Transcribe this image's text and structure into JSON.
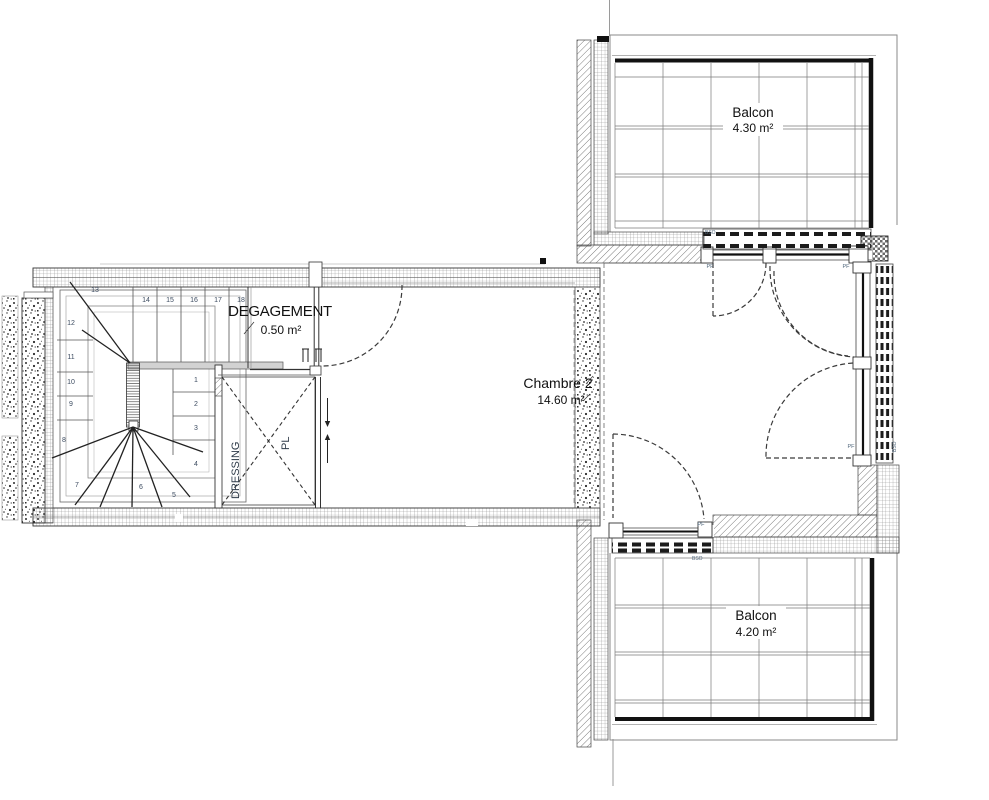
{
  "plan": {
    "rooms": {
      "degagement": {
        "name": "DEGAGEMENT",
        "area": "0.50 m²"
      },
      "chambre2": {
        "name": "Chambre 2",
        "area": "14.60 m²"
      },
      "balcon_top": {
        "name": "Balcon",
        "area": "4.30 m²"
      },
      "balcon_bottom": {
        "name": "Balcon",
        "area": "4.20 m²"
      },
      "dressing": {
        "name": "DRESSING"
      },
      "placard": {
        "name": "PL"
      }
    },
    "stair_steps": [
      "1",
      "2",
      "3",
      "4",
      "5",
      "6",
      "7",
      "8",
      "9",
      "10",
      "11",
      "12",
      "13",
      "14",
      "15",
      "16",
      "17",
      "18"
    ],
    "window_labels": {
      "pf": "PF",
      "bso": "BSO"
    },
    "colors": {
      "ink": "#1a1a1a",
      "small_label": "#51677c",
      "stair_number": "#3d4c61"
    }
  }
}
